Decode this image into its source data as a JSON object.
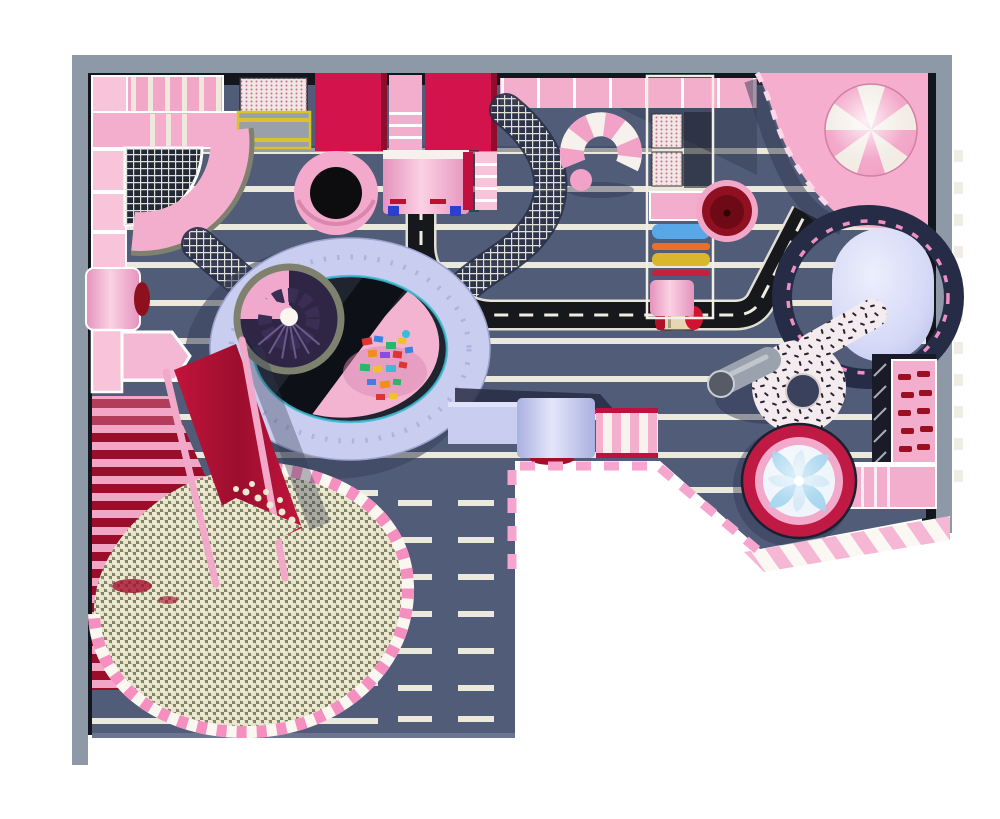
{
  "scene": {
    "title": "candy-theme-indoor-playground-floor-plan-top-view"
  },
  "palette": {
    "wall": "#8e99a7",
    "liner": "#14161d",
    "floor": "#515c78",
    "floorShadow": "#3a4259",
    "stripe": "#ebe8dc",
    "pink": "#f4aecd",
    "pinkLight": "#f7c4da",
    "pinkDeep": "#ee8fbc",
    "crimson": "#d3134c",
    "slideRed": "#b01031",
    "maroon": "#8e0f1e",
    "lavender": "#c9cdef",
    "lavenderLight": "#e3e6fa",
    "black": "#0c0d12",
    "road": "#17181c",
    "ballBeige": "#ecead0",
    "ballShadow": "#83816a",
    "teal": "#38bdd3",
    "blue": "#5aa7e8",
    "yellow": "#d9b62c",
    "orange": "#e8702c",
    "cream": "#f2eee6",
    "swirlBlue": "#a7d6ef",
    "grayTube": "#9aa3ad",
    "olive": "#7d816e",
    "navyNet": "#232838",
    "candyTrim": "#f6a5ce",
    "spiralDark": "#2f2545"
  },
  "zones": {
    "perimeter_wall": "perimeter-wall",
    "striped_floor": "striped-soft-floor",
    "panel_wall": "activity-panel-wall",
    "quarter_net": "quarter-circle-climb-net",
    "walkway": "curved-pink-walkway",
    "net_bridge": "net-crawl-bridge",
    "crimson_boxes": "crimson-slide-boxes",
    "tube_barrel": "pink-tube-barrel",
    "trampoline": "round-black-trampoline",
    "candy_tube": "candy-cane-hook-tube",
    "roller_tower": "roller-play-tower",
    "red_bowl": "red-spinning-bowl",
    "candy_deck": "pink-candy-deck",
    "giant_lollipop": "giant-pinwheel-lollipop",
    "airbag": "lavender-airbag",
    "sprinkle_donut": "sprinkle-donut-slide",
    "crawl_tube": "gray-crawl-tube",
    "climb_wall": "climbing-wall-with-grips",
    "stairs": "pink-stair-walkway",
    "swirl_pool": "lollipop-swirl-spin-pool",
    "candy_band": "candy-stripe-walk",
    "dashed_boundary": "dashed-zone-boundary",
    "road": "toy-road-track",
    "car": "ride-on-toy-car",
    "donut_ring": "oval-ring-walkway",
    "spiral": "spiral-slide-tower",
    "blocks": "toy-building-blocks",
    "roller_steps": "roller-slide-steps",
    "big_slide": "big-red-wave-slide",
    "ball_pit": "giant-ball-pit"
  }
}
